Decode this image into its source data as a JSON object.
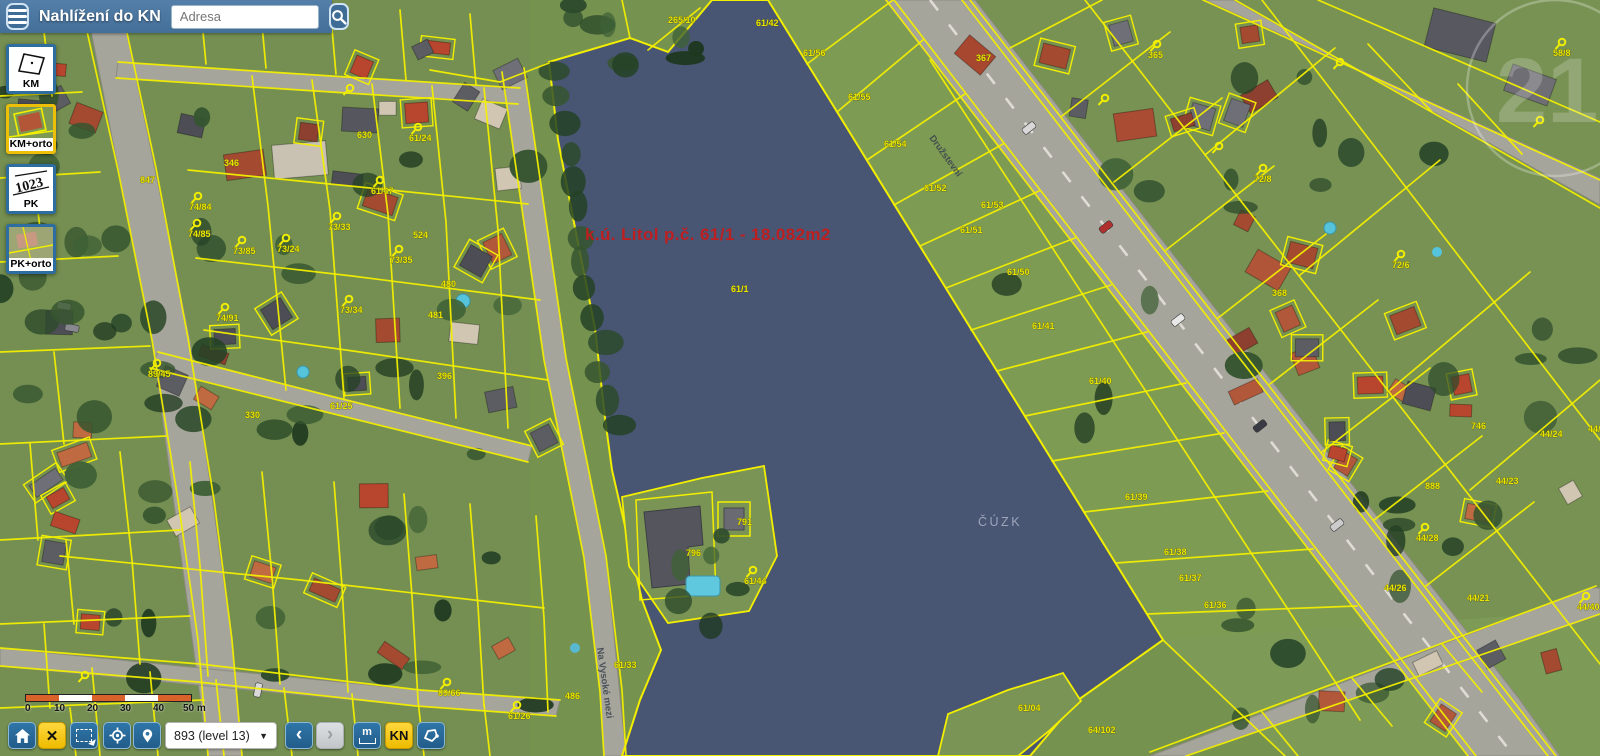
{
  "header": {
    "title": "Nahlížení do KN",
    "search_placeholder": "Adresa"
  },
  "layer_tiles": [
    {
      "label": "KM",
      "selected": false
    },
    {
      "label": "KM+orto",
      "selected": true
    },
    {
      "label": "PK",
      "selected": false
    },
    {
      "label": "PK+orto",
      "selected": false
    }
  ],
  "map": {
    "selection_label": {
      "text": "k.ú. Litol p.č. 61/1 - 18.082m2",
      "x": 585,
      "y": 240
    },
    "watermark_center": "ČÚZK",
    "watermark_corner": "21",
    "street_labels": [
      {
        "text": "Na Vysoké mezi",
        "x": 597,
        "y": 648,
        "rot": 82
      },
      {
        "text": "Družstevní",
        "x": 929,
        "y": 138,
        "rot": 54
      }
    ],
    "parcel_labels": [
      {
        "t": "847",
        "x": 140,
        "y": 183
      },
      {
        "t": "346",
        "x": 224,
        "y": 166
      },
      {
        "t": "630",
        "x": 357,
        "y": 138
      },
      {
        "t": "61/24",
        "x": 409,
        "y": 141,
        "m": 1
      },
      {
        "t": "61/47",
        "x": 371,
        "y": 194,
        "m": 1
      },
      {
        "t": "74/84",
        "x": 189,
        "y": 210,
        "m": 1
      },
      {
        "t": "74/85",
        "x": 188,
        "y": 237,
        "m": 1
      },
      {
        "t": "73/33",
        "x": 328,
        "y": 230,
        "m": 1
      },
      {
        "t": "524",
        "x": 413,
        "y": 238
      },
      {
        "t": "73/85",
        "x": 233,
        "y": 254,
        "m": 1
      },
      {
        "t": "73/24",
        "x": 277,
        "y": 252,
        "m": 1
      },
      {
        "t": "73/35",
        "x": 390,
        "y": 263,
        "m": 1
      },
      {
        "t": "480",
        "x": 441,
        "y": 287
      },
      {
        "t": "73/34",
        "x": 340,
        "y": 313,
        "m": 1
      },
      {
        "t": "74/91",
        "x": 216,
        "y": 321,
        "m": 1
      },
      {
        "t": "481",
        "x": 428,
        "y": 318
      },
      {
        "t": "89/45",
        "x": 148,
        "y": 377,
        "m": 1
      },
      {
        "t": "330",
        "x": 245,
        "y": 418
      },
      {
        "t": "61/25",
        "x": 330,
        "y": 409
      },
      {
        "t": "396",
        "x": 437,
        "y": 379
      },
      {
        "t": "89/66",
        "x": 438,
        "y": 696,
        "m": 1
      },
      {
        "t": "61/26",
        "x": 508,
        "y": 719,
        "m": 1
      },
      {
        "t": "486",
        "x": 565,
        "y": 699
      },
      {
        "t": "61/33",
        "x": 614,
        "y": 668
      },
      {
        "t": "265/10",
        "x": 668,
        "y": 23
      },
      {
        "t": "61/42",
        "x": 756,
        "y": 26
      },
      {
        "t": "61/56",
        "x": 803,
        "y": 56
      },
      {
        "t": "61/55",
        "x": 848,
        "y": 100
      },
      {
        "t": "61/54",
        "x": 884,
        "y": 147
      },
      {
        "t": "61/52",
        "x": 924,
        "y": 191
      },
      {
        "t": "61/53",
        "x": 981,
        "y": 208
      },
      {
        "t": "61/51",
        "x": 960,
        "y": 233
      },
      {
        "t": "61/50",
        "x": 1007,
        "y": 275
      },
      {
        "t": "61/41",
        "x": 1032,
        "y": 329
      },
      {
        "t": "61/40",
        "x": 1089,
        "y": 384
      },
      {
        "t": "61/39",
        "x": 1125,
        "y": 500
      },
      {
        "t": "61/38",
        "x": 1164,
        "y": 555
      },
      {
        "t": "61/37",
        "x": 1179,
        "y": 581
      },
      {
        "t": "61/36",
        "x": 1204,
        "y": 608
      },
      {
        "t": "61/1",
        "x": 731,
        "y": 292
      },
      {
        "t": "796",
        "x": 686,
        "y": 556
      },
      {
        "t": "791",
        "x": 737,
        "y": 525
      },
      {
        "t": "61/44",
        "x": 744,
        "y": 584,
        "m": 1
      },
      {
        "t": "61/04",
        "x": 1018,
        "y": 711
      },
      {
        "t": "64/102",
        "x": 1088,
        "y": 733
      },
      {
        "t": "367",
        "x": 976,
        "y": 61
      },
      {
        "t": "365",
        "x": 1148,
        "y": 58,
        "m": 1
      },
      {
        "t": "72/8",
        "x": 1254,
        "y": 182,
        "m": 1
      },
      {
        "t": "72/6",
        "x": 1392,
        "y": 268,
        "m": 1
      },
      {
        "t": "368",
        "x": 1272,
        "y": 296
      },
      {
        "t": "58/8",
        "x": 1553,
        "y": 56,
        "m": 1
      },
      {
        "t": "746",
        "x": 1471,
        "y": 429
      },
      {
        "t": "44/24",
        "x": 1540,
        "y": 437
      },
      {
        "t": "44/41",
        "x": 1588,
        "y": 432
      },
      {
        "t": "44/23",
        "x": 1496,
        "y": 484
      },
      {
        "t": "888",
        "x": 1425,
        "y": 489
      },
      {
        "t": "44/28",
        "x": 1416,
        "y": 541,
        "m": 1
      },
      {
        "t": "44/26",
        "x": 1384,
        "y": 591
      },
      {
        "t": "44/21",
        "x": 1467,
        "y": 601
      },
      {
        "t": "44/40",
        "x": 1577,
        "y": 610,
        "m": 1
      }
    ]
  },
  "scalebar": {
    "ticks": [
      "0",
      "10",
      "20",
      "30",
      "40"
    ],
    "last": "50 m"
  },
  "toolbar": {
    "close_glyph": "✕",
    "zoom_value": "893 (level 13)",
    "back_glyph": "‹",
    "forward_glyph": "›",
    "measure_label": "m",
    "kn_label": "KN"
  }
}
